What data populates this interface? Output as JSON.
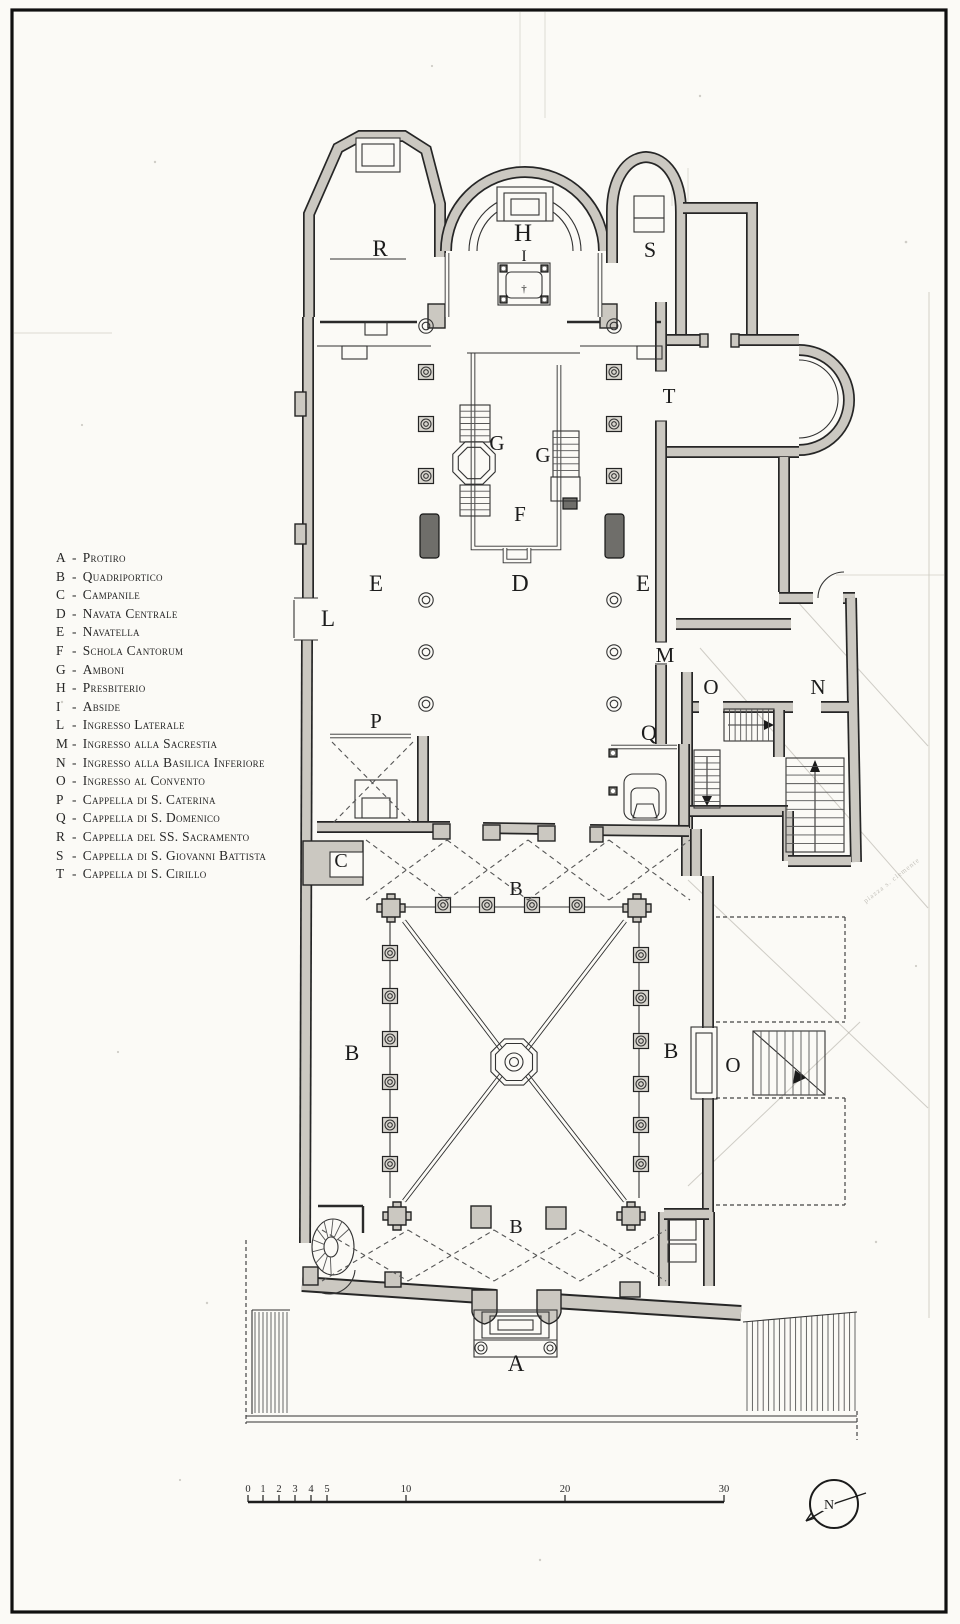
{
  "colors": {
    "ink": "#1f1f1f",
    "wall_fill": "#cbc8c1",
    "page": "#fbfaf6"
  },
  "legend": {
    "items": [
      {
        "key": "A",
        "label": "Protiro"
      },
      {
        "key": "B",
        "label": "Quadriportico"
      },
      {
        "key": "C",
        "label": "Campanile"
      },
      {
        "key": "D",
        "label": "Navata Centrale"
      },
      {
        "key": "E",
        "label": "Navatella"
      },
      {
        "key": "F",
        "label": "Schola Cantorum"
      },
      {
        "key": "G",
        "label": "Amboni"
      },
      {
        "key": "H",
        "label": "Presbiterio"
      },
      {
        "key": "I",
        "label": "Abside"
      },
      {
        "key": "L",
        "label": "Ingresso Laterale"
      },
      {
        "key": "M",
        "label": "Ingresso alla Sacrestia"
      },
      {
        "key": "N",
        "label": "Ingresso alla Basilica Inferiore"
      },
      {
        "key": "O",
        "label": "Ingresso al Convento"
      },
      {
        "key": "P",
        "label": "Cappella di S. Caterina"
      },
      {
        "key": "Q",
        "label": "Cappella di S. Domenico"
      },
      {
        "key": "R",
        "label": "Cappella del SS. Sacramento"
      },
      {
        "key": "S",
        "label": "Cappella di S. Giovanni Battista"
      },
      {
        "key": "T",
        "label": "Cappella di S. Cirillo"
      }
    ]
  },
  "plan_labels": [
    {
      "text": "R",
      "x": 380,
      "y": 256,
      "size": 23
    },
    {
      "text": "H",
      "x": 523,
      "y": 241,
      "size": 25
    },
    {
      "text": "I",
      "x": 524,
      "y": 261,
      "size": 16
    },
    {
      "text": "S",
      "x": 650,
      "y": 257,
      "size": 22
    },
    {
      "text": "T",
      "x": 669,
      "y": 403,
      "size": 21
    },
    {
      "text": "G",
      "x": 497,
      "y": 450,
      "size": 21
    },
    {
      "text": "G",
      "x": 543,
      "y": 462,
      "size": 21
    },
    {
      "text": "F",
      "x": 520,
      "y": 521,
      "size": 21
    },
    {
      "text": "E",
      "x": 376,
      "y": 591,
      "size": 23
    },
    {
      "text": "D",
      "x": 520,
      "y": 591,
      "size": 24
    },
    {
      "text": "E",
      "x": 643,
      "y": 591,
      "size": 23
    },
    {
      "text": "L",
      "x": 328,
      "y": 626,
      "size": 23
    },
    {
      "text": "M",
      "x": 665,
      "y": 662,
      "size": 21
    },
    {
      "text": "O",
      "x": 711,
      "y": 694,
      "size": 21
    },
    {
      "text": "N",
      "x": 818,
      "y": 694,
      "size": 21
    },
    {
      "text": "Q",
      "x": 649,
      "y": 740,
      "size": 22
    },
    {
      "text": "P",
      "x": 376,
      "y": 728,
      "size": 21
    },
    {
      "text": "C",
      "x": 341,
      "y": 867,
      "size": 20
    },
    {
      "text": "B",
      "x": 516,
      "y": 895,
      "size": 20
    },
    {
      "text": "B",
      "x": 352,
      "y": 1060,
      "size": 22
    },
    {
      "text": "B",
      "x": 671,
      "y": 1058,
      "size": 22
    },
    {
      "text": "B",
      "x": 516,
      "y": 1233,
      "size": 20
    },
    {
      "text": "O",
      "x": 733,
      "y": 1072,
      "size": 21
    },
    {
      "text": "A",
      "x": 516,
      "y": 1371,
      "size": 23
    }
  ],
  "scale_bar": {
    "y": 1502,
    "x_start": 248,
    "x_end": 724,
    "unit_ticks": [
      {
        "label": "0",
        "x": 248
      },
      {
        "label": "1",
        "x": 263
      },
      {
        "label": "2",
        "x": 279
      },
      {
        "label": "3",
        "x": 295
      },
      {
        "label": "4",
        "x": 311
      },
      {
        "label": "5",
        "x": 327
      },
      {
        "label": "10",
        "x": 406
      },
      {
        "label": "20",
        "x": 565
      },
      {
        "label": "30",
        "x": 724
      }
    ]
  },
  "compass": {
    "label": "N",
    "cx": 834,
    "cy": 1504,
    "r": 24
  },
  "pencil_note": {
    "text": "piazza s. clemente",
    "x": 893,
    "y": 882,
    "rotation": -38
  }
}
